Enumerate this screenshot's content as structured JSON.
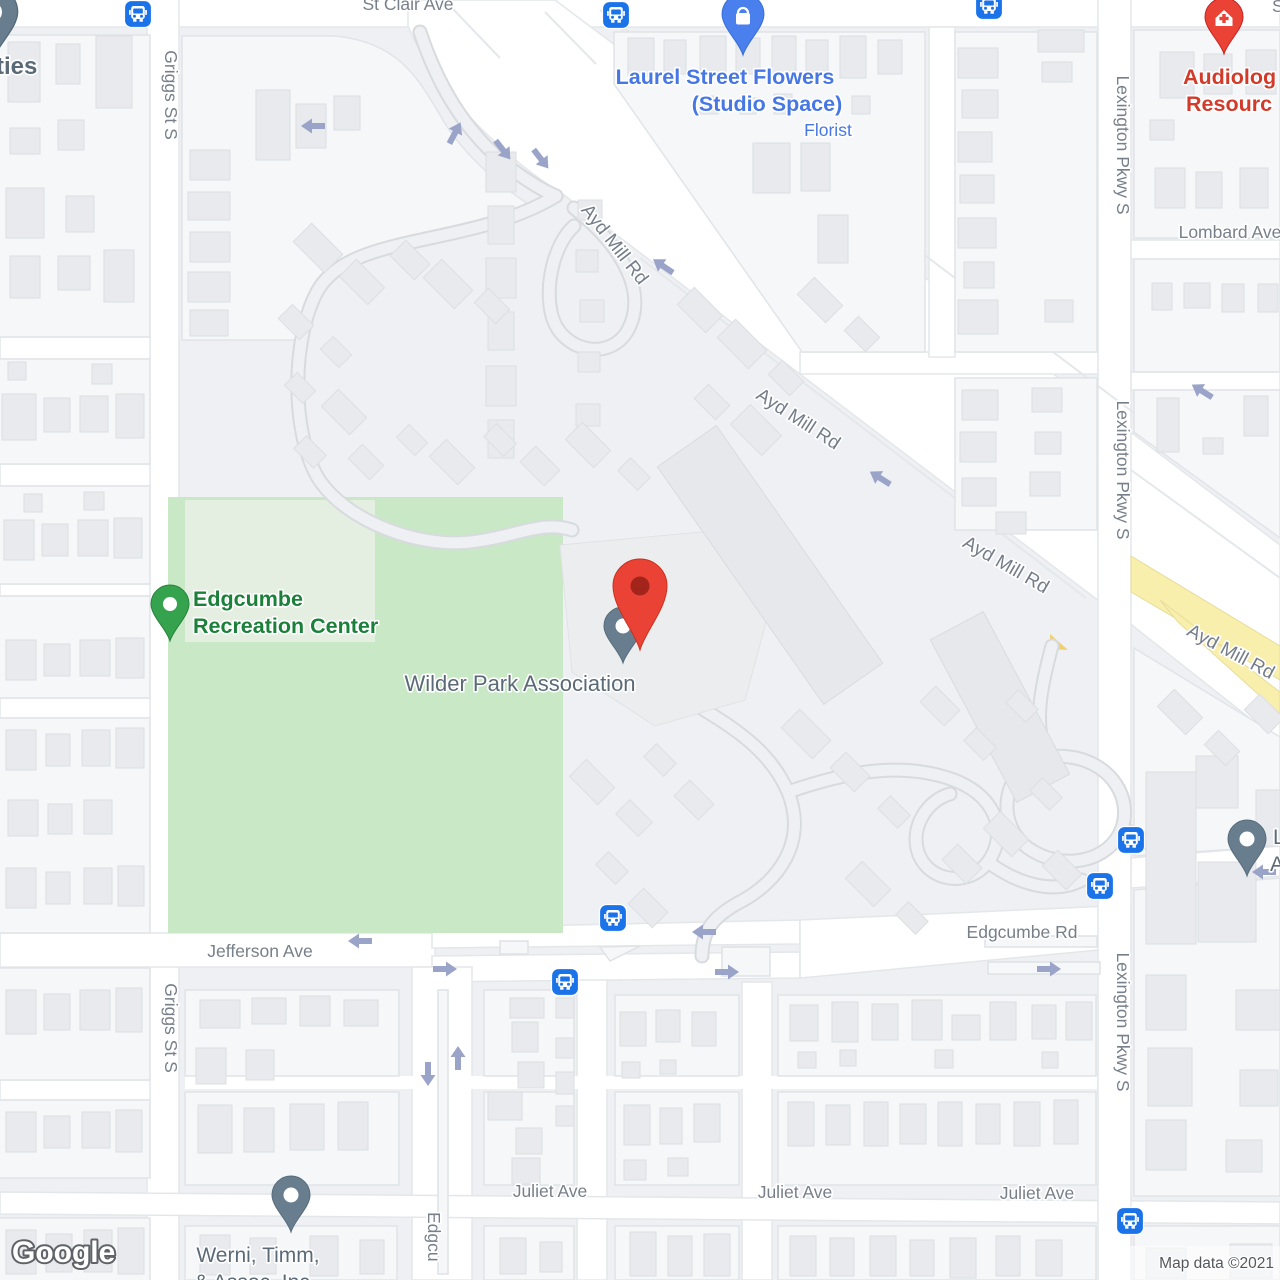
{
  "map": {
    "attribution": "Map data ©2021",
    "logo_label": "Google"
  },
  "streets": {
    "st_clair": "St Clair Ave",
    "st_clair_partial": "S",
    "griggs": "Griggs St S",
    "ayd_mill": "Ayd Mill Rd",
    "lexington": "Lexington Pkwy S",
    "lombard": "Lombard Ave",
    "jefferson": "Jefferson Ave",
    "edgcumbe_rd": "Edgcumbe Rd",
    "edgcumbe_partial": "Edgcu",
    "juliet": "Juliet Ave"
  },
  "pois": {
    "laurel": {
      "name_line1": "Laurel Street Flowers",
      "name_line2": "(Studio Space)",
      "category": "Florist",
      "color": "#4677e4",
      "pin": "shopping-bag-pin"
    },
    "audiology": {
      "name_line1": "Audiolog",
      "name_line2": "Resourc",
      "color": "#d23a2a",
      "pin": "health-pin"
    },
    "recreation": {
      "name_line1": "Edgcumbe",
      "name_line2": "Recreation Center",
      "color": "#1b8039",
      "pin": "park-pin"
    },
    "wilder": {
      "name": "Wilder Park Association",
      "color": "#5b6a77",
      "pin": "red-location-marker"
    },
    "werni": {
      "name_line1": "Werni, Timm,",
      "name_line2": "& Assoc. Inc",
      "color": "#5b6a77",
      "pin": "gray-poi-pin"
    },
    "partial_left": {
      "name": "ties",
      "color": "#5b6a77"
    },
    "partial_right": {
      "name_line1": "L",
      "name_line2": "A",
      "color": "#5b6a77",
      "pin": "gray-poi-pin"
    }
  },
  "markers": {
    "main_pin": "red-location-marker",
    "transit": "bus-stop-icon",
    "direction": "one-way-arrow-icon"
  },
  "colors": {
    "park_green": "#c9e8c6",
    "road_white": "#ffffff",
    "highway_yellow": "#f9efad",
    "transit_blue": "#1a73e8",
    "marker_red": "#ea4336",
    "pin_gray": "#687d8e",
    "pin_green": "#35a24e",
    "street_label": "#777f8a"
  }
}
